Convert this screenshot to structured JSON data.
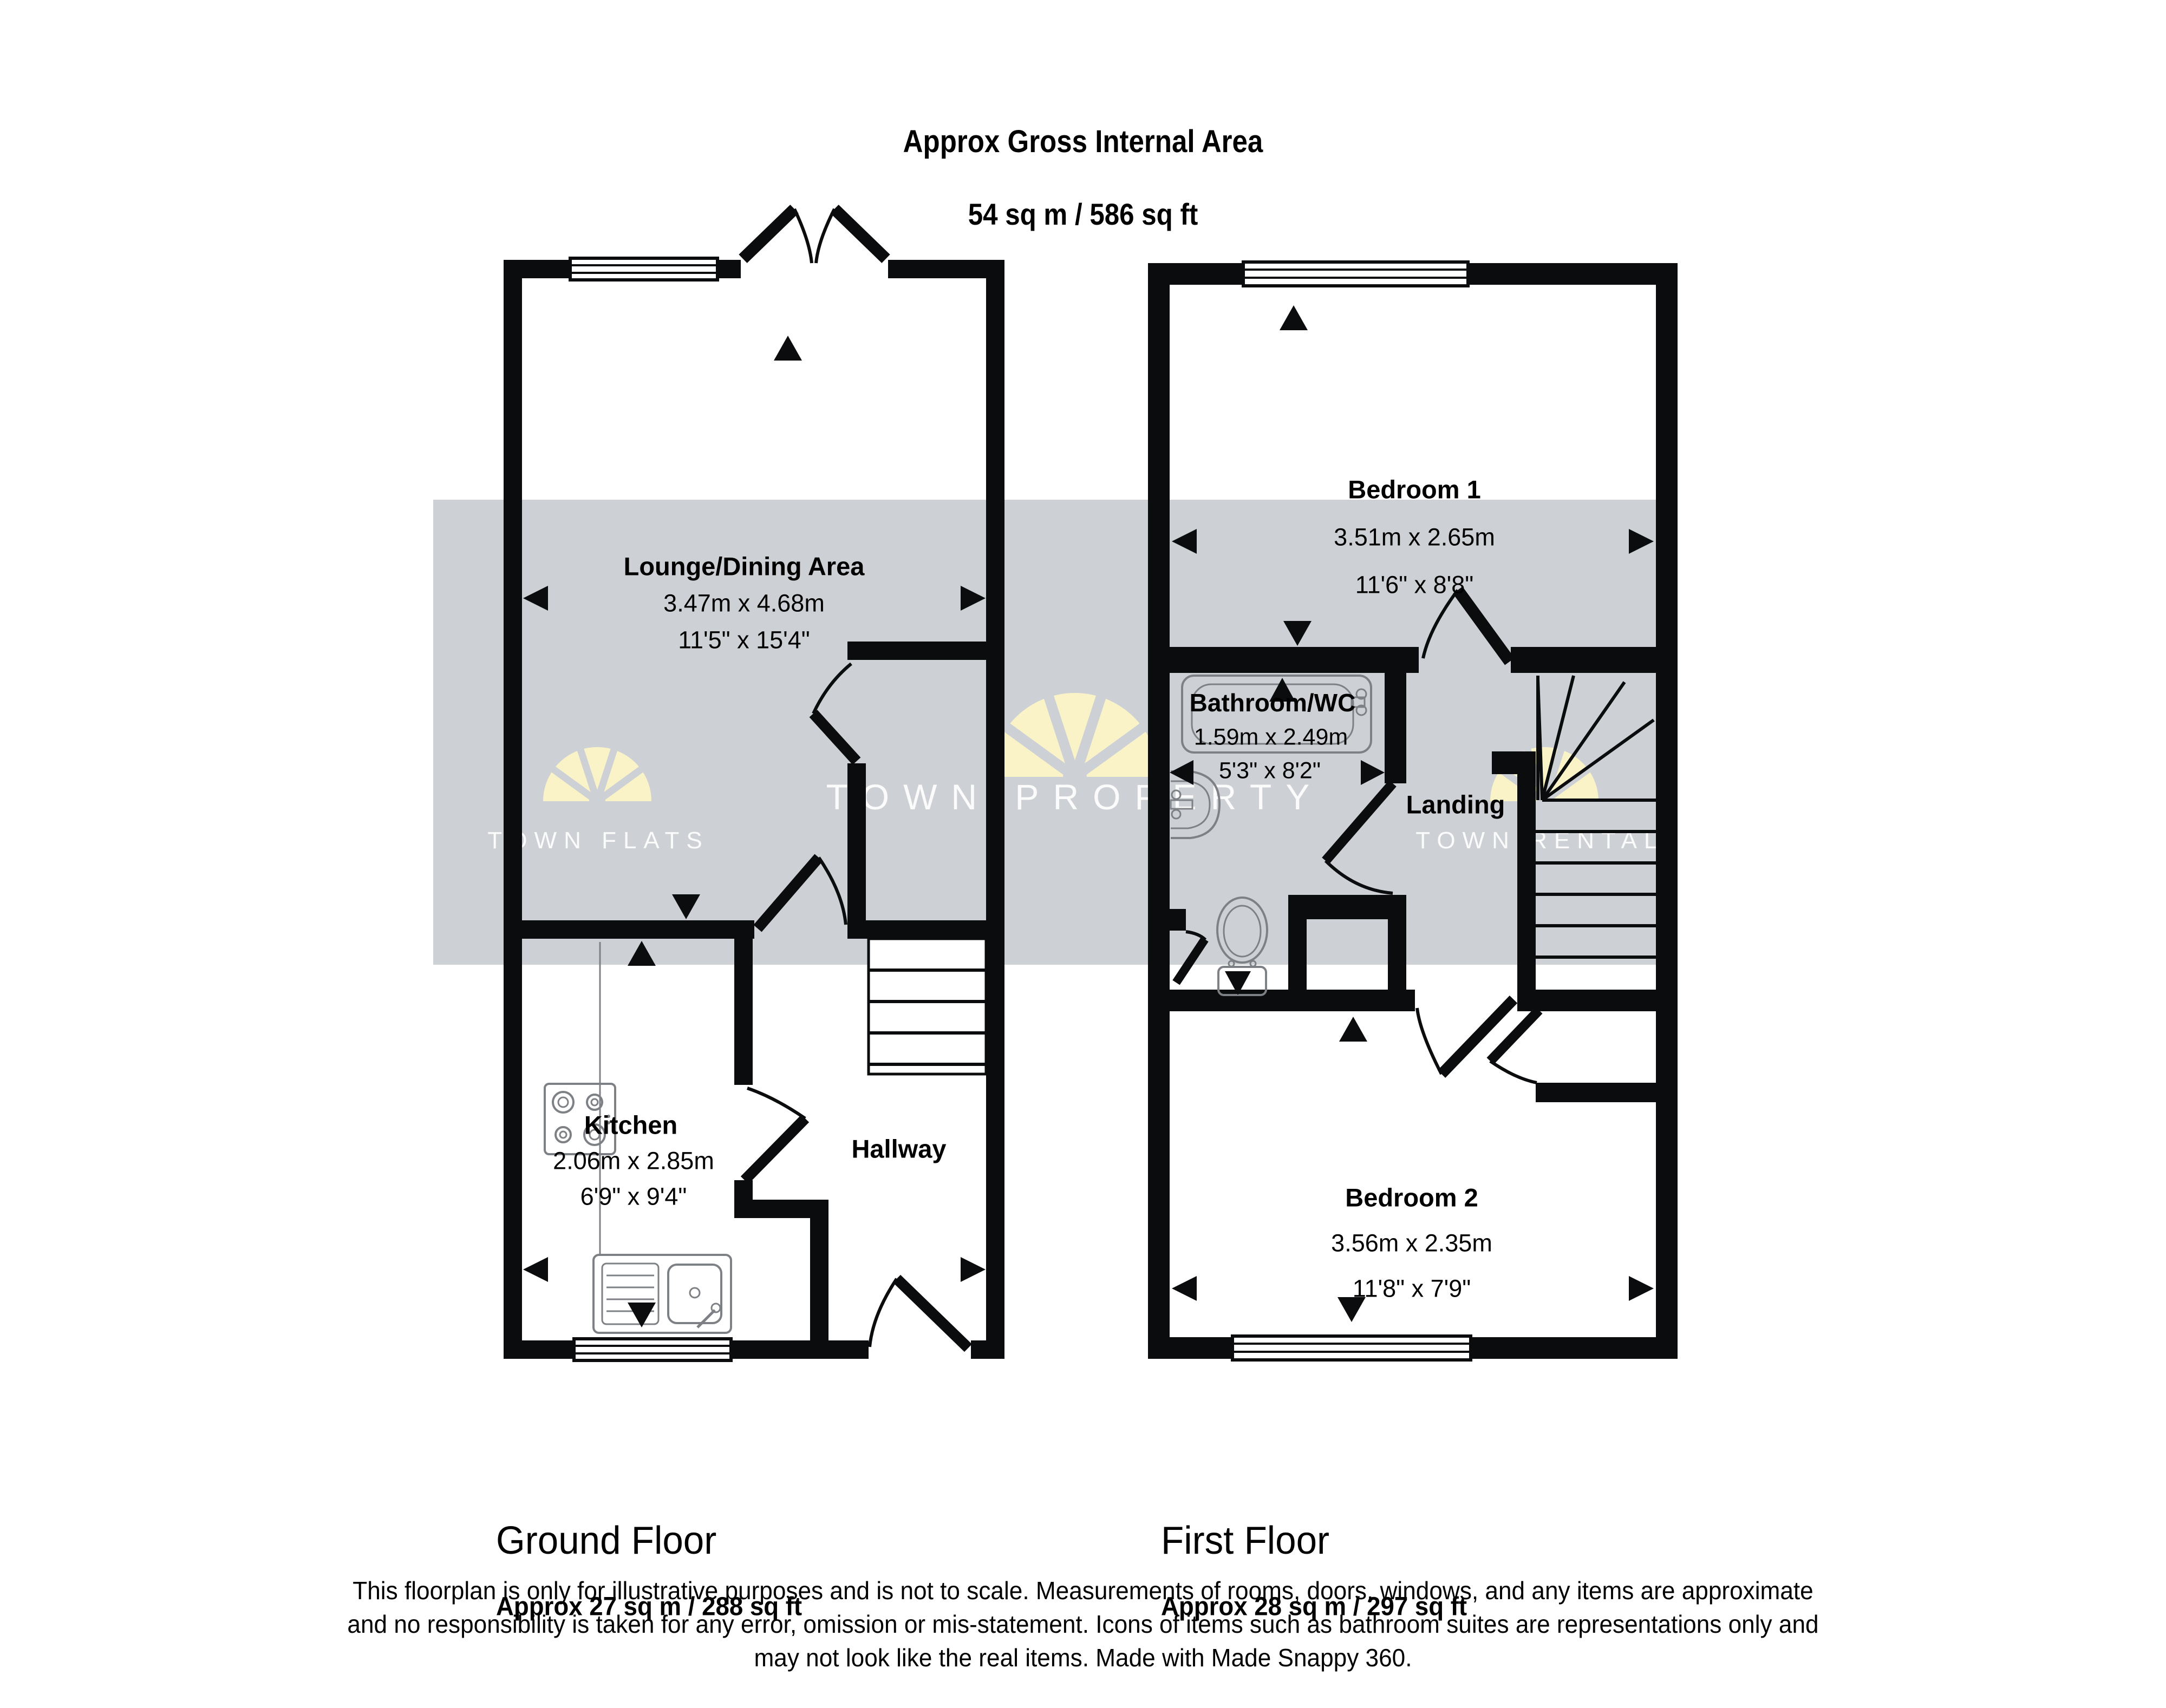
{
  "header": {
    "title": "Approx Gross Internal Area",
    "subtitle": "54 sq m / 586 sq ft"
  },
  "watermarks": {
    "left": "TOWN FLATS",
    "center": "TOWN PROPERTY",
    "right": "TOWN RENTALS"
  },
  "colors": {
    "wall": "#0a0c0d",
    "band": "#cdd1d5",
    "fan": "#faf3c8",
    "page": "#ffffff",
    "watermark_text": "#ffffff",
    "ink": "#000000"
  },
  "ground_floor": {
    "name": "Ground Floor",
    "area": "Approx 27 sq m / 288 sq ft",
    "lounge": {
      "name": "Lounge/Dining Area",
      "metric": "3.47m x 4.68m",
      "imperial": "11'5\" x 15'4\""
    },
    "kitchen": {
      "name": "Kitchen",
      "metric": "2.06m x 2.85m",
      "imperial": "6'9\" x 9'4\""
    },
    "hallway": {
      "name": "Hallway"
    }
  },
  "first_floor": {
    "name": "First Floor",
    "area": "Approx 28 sq m / 297 sq ft",
    "bedroom1": {
      "name": "Bedroom 1",
      "metric": "3.51m x 2.65m",
      "imperial": "11'6\" x 8'8\""
    },
    "bathroom": {
      "name": "Bathroom/WC",
      "metric": "1.59m x 2.49m",
      "imperial": "5'3\" x 8'2\""
    },
    "landing": {
      "name": "Landing"
    },
    "bedroom2": {
      "name": "Bedroom 2",
      "metric": "3.56m x 2.35m",
      "imperial": "11'8\" x 7'9\""
    }
  },
  "disclaimer": {
    "line1": "This floorplan is only for illustrative purposes and is not to scale. Measurements of rooms, doors, windows, and any items are approximate",
    "line2": "and no responsibility is taken for any error, omission or mis-statement. Icons of items such as bathroom suites are representations only and",
    "line3": "may not look like the real items. Made with Made Snappy 360."
  }
}
